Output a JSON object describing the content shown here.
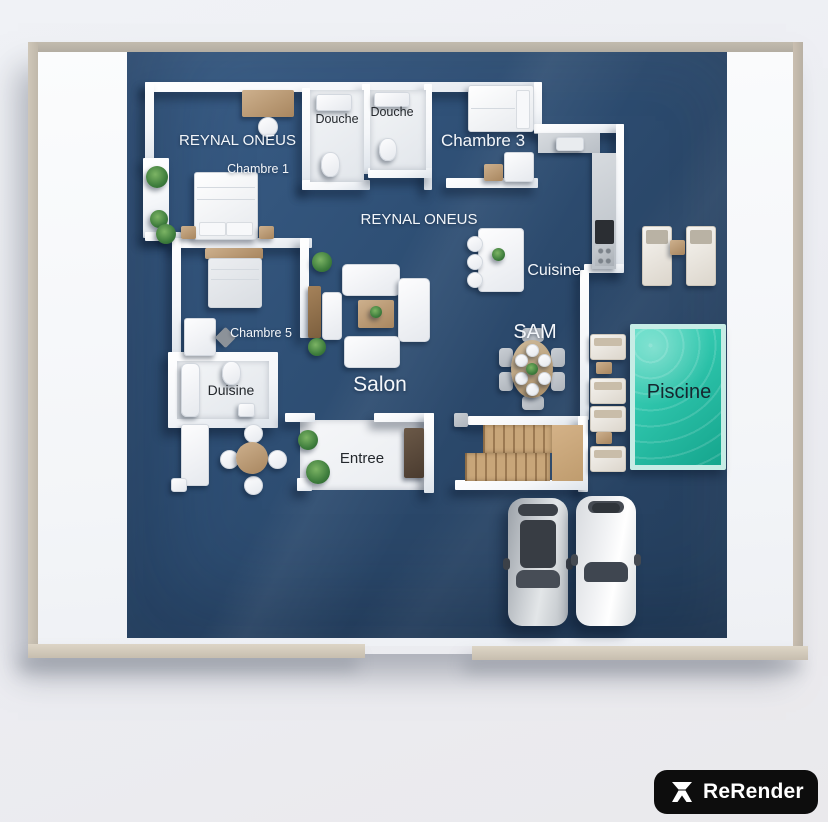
{
  "scene": {
    "type": "3d-floor-plan-render",
    "colors": {
      "background": "#edeff3",
      "floor_blue": "#2d4c6f",
      "pool_water": "#2cc2a9",
      "frame_beige": "#c9c0b1",
      "walls_white": "#ffffff",
      "badge_bg": "#0d0d0d",
      "badge_fg": "#ffffff"
    }
  },
  "labels": {
    "watermark_top": "REYNAL ONEUS",
    "watermark_mid": "REYNAL ONEUS",
    "chambre1": "Chambre 1",
    "chambre3": "Chambre 3",
    "chambre5": "Chambre 5",
    "douche_left": "Douche",
    "douche_right": "Douche",
    "cuisine": "Cuisine",
    "sam": "SAM",
    "salon": "Salon",
    "duisine": "Duisine",
    "entree": "Entree",
    "piscine": "Piscine"
  },
  "branding": {
    "logo_text": "ReRender"
  }
}
